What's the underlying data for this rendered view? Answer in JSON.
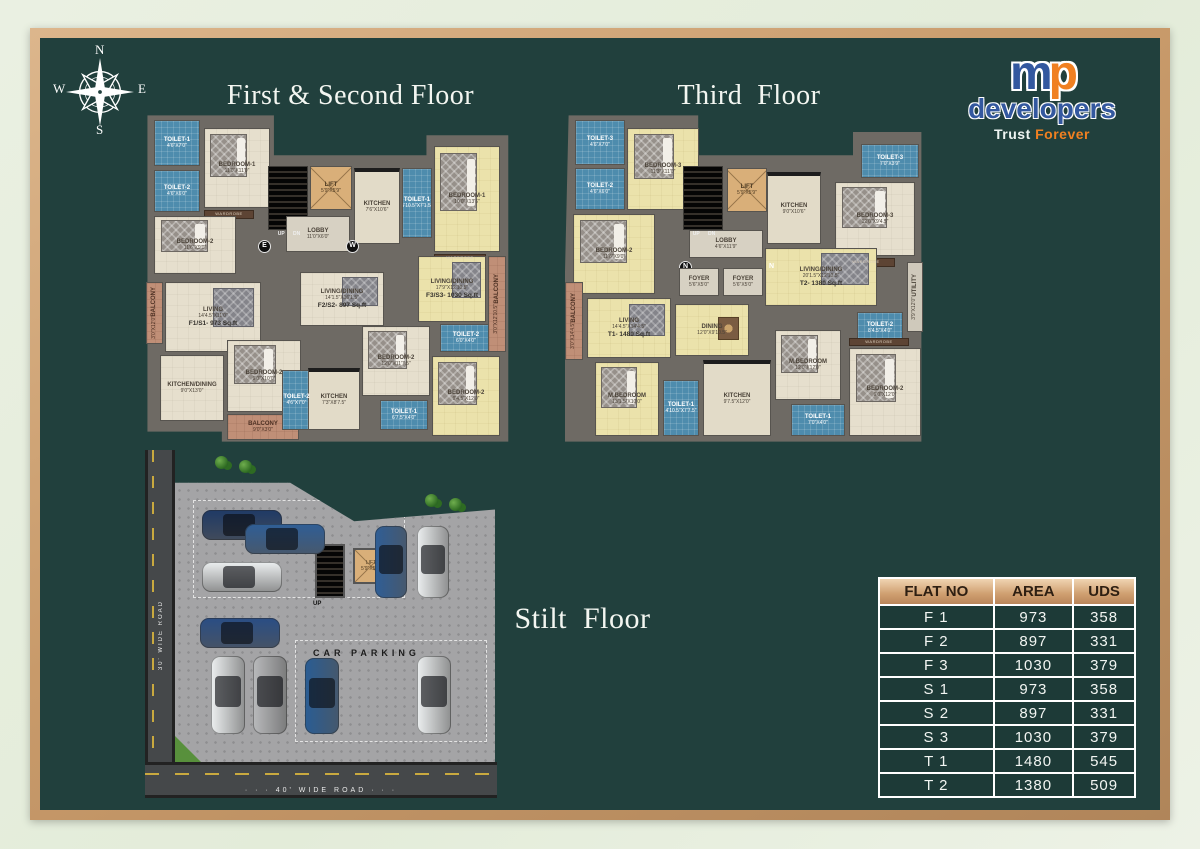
{
  "titles": {
    "first_second": "First & Second Floor",
    "third": "Third  Floor",
    "stilt": "Stilt  Floor"
  },
  "compass": {
    "n": "N",
    "e": "E",
    "s": "S",
    "w": "W"
  },
  "logo": {
    "m": "m",
    "p": "p",
    "name": "developers",
    "tagline_1": "Trust",
    "tagline_2": "Forever",
    "blue": "#33589f",
    "orange": "#f08021"
  },
  "colors": {
    "panel": "#21403d",
    "frame": "#c89a6a",
    "table_header": "#cf9f70",
    "toilet_blue": "#4e8cad",
    "flat_yellow": "#ebe2ab",
    "room_cream": "#e6dfcd"
  },
  "plans": {
    "first_second": {
      "rooms": [
        {
          "t": "toilet",
          "n": "TOILET-1",
          "d": "4'6\"X7'0\"",
          "x": 14,
          "y": 8,
          "w": 46,
          "h": 46
        },
        {
          "t": "toilet",
          "n": "TOILET-2",
          "d": "4'6\"X6'0\"",
          "x": 14,
          "y": 58,
          "w": 46,
          "h": 42
        },
        {
          "t": "room",
          "n": "BEDROOM-1",
          "d": "11'0\"X11'0\"",
          "x": 64,
          "y": 16,
          "w": 66,
          "h": 80,
          "deco": "bed"
        },
        {
          "t": "wb",
          "n": "WARDROBE",
          "x": 64,
          "y": 98,
          "w": 50,
          "h": 9
        },
        {
          "t": "room",
          "n": "BEDROOM-2",
          "d": "11'6\"X9'0\"",
          "x": 14,
          "y": 104,
          "w": 82,
          "h": 58,
          "deco": "bed"
        },
        {
          "t": "stairs",
          "x": 128,
          "y": 54,
          "w": 40,
          "h": 64
        },
        {
          "t": "txt",
          "n": "UP      DN",
          "x": 126,
          "y": 119,
          "w": 46,
          "h": 8
        },
        {
          "t": "lift",
          "n": "LIFT",
          "d": "5'9\"X5'9\"",
          "x": 170,
          "y": 54,
          "w": 42,
          "h": 44
        },
        {
          "t": "lobby",
          "n": "LOBBY",
          "d": "11'0\"X6'0\"",
          "x": 146,
          "y": 104,
          "w": 64,
          "h": 36
        },
        {
          "t": "kitchen",
          "n": "KITCHEN",
          "d": "7'6\"X10'6\"",
          "x": 214,
          "y": 56,
          "w": 46,
          "h": 76
        },
        {
          "t": "toilet",
          "n": "TOILET-1",
          "d": "5'10.5\"X7'1.5\"",
          "x": 262,
          "y": 56,
          "w": 30,
          "h": 70
        },
        {
          "t": "yroom",
          "n": "BEDROOM-1",
          "d": "10'0\"X13'6\"",
          "x": 294,
          "y": 34,
          "w": 66,
          "h": 106,
          "deco": "bed"
        },
        {
          "t": "wb",
          "n": "WARDROBE",
          "x": 294,
          "y": 142,
          "w": 52,
          "h": 9
        },
        {
          "t": "dir",
          "n": "E",
          "x": 118,
          "y": 128
        },
        {
          "t": "dir",
          "n": "W",
          "x": 206,
          "y": 128
        },
        {
          "t": "balc",
          "n": "BALCONY",
          "d": "3'0\"X12'0\"",
          "x": 6,
          "y": 170,
          "w": 17,
          "h": 62,
          "v": 1
        },
        {
          "t": "room",
          "n": "LIVING",
          "d": "14'4.5\"X11'0\"",
          "a": "F1/S1- 973 Sq.ft",
          "x": 25,
          "y": 170,
          "w": 96,
          "h": 70,
          "deco": "rug"
        },
        {
          "t": "room",
          "n": "KITCHEN/DINING",
          "d": "9'0\"X13'0\"",
          "x": 20,
          "y": 243,
          "w": 64,
          "h": 66
        },
        {
          "t": "room",
          "n": "BEDROOM-2",
          "d": "9'0\"X10'0\"",
          "x": 87,
          "y": 228,
          "w": 74,
          "h": 72,
          "deco": "bed"
        },
        {
          "t": "balc",
          "n": "BALCONY",
          "d": "9'0\"X3'0\"",
          "x": 87,
          "y": 302,
          "w": 72,
          "h": 26
        },
        {
          "t": "toilet",
          "n": "TOILET-2",
          "d": "4'6\"X7'0\"",
          "x": 142,
          "y": 258,
          "w": 29,
          "h": 60
        },
        {
          "t": "room",
          "n": "LIVING/DINING",
          "d": "14'1.5\"X16'1.5\"",
          "a": "F2/S2- 897 Sq.ft",
          "x": 160,
          "y": 160,
          "w": 84,
          "h": 54,
          "deco": "rug"
        },
        {
          "t": "kitchen",
          "n": "KITCHEN",
          "d": "7'3\"X8'7.5\"",
          "x": 168,
          "y": 256,
          "w": 52,
          "h": 62
        },
        {
          "t": "room",
          "n": "BEDROOM-2",
          "d": "12'0\"X11'7.5\"",
          "x": 222,
          "y": 214,
          "w": 68,
          "h": 70,
          "deco": "bed"
        },
        {
          "t": "toilet",
          "n": "TOILET-1",
          "d": "6'7.5\"X4'0\"",
          "x": 240,
          "y": 288,
          "w": 48,
          "h": 30
        },
        {
          "t": "yroom",
          "n": "LIVING/DINING",
          "d": "17'9\"X12'10.5\"",
          "a": "F3/S3- 1030 Sq.ft",
          "x": 278,
          "y": 144,
          "w": 68,
          "h": 66,
          "deco": "rug"
        },
        {
          "t": "toilet",
          "n": "TOILET-2",
          "d": "6'0\"X4'0\"",
          "x": 300,
          "y": 212,
          "w": 52,
          "h": 28
        },
        {
          "t": "yroom",
          "n": "BEDROOM-2",
          "d": "9'4.5\"X12'0\"",
          "x": 292,
          "y": 244,
          "w": 68,
          "h": 80,
          "deco": "bed"
        },
        {
          "t": "balc",
          "n": "BALCONY",
          "d": "3'0\"X12'10.5\"",
          "x": 348,
          "y": 144,
          "w": 18,
          "h": 96,
          "v": 1
        }
      ]
    },
    "third": {
      "rooms": [
        {
          "t": "toilet",
          "n": "TOILET-3",
          "d": "4'6\"X7'0\"",
          "x": 10,
          "y": 8,
          "w": 50,
          "h": 45
        },
        {
          "t": "toilet",
          "n": "TOILET-2",
          "d": "4'6\"X6'0\"",
          "x": 10,
          "y": 56,
          "w": 50,
          "h": 42
        },
        {
          "t": "yroom",
          "n": "BEDROOM-3",
          "d": "11'3\"X11'0\"",
          "x": 62,
          "y": 16,
          "w": 72,
          "h": 82,
          "deco": "bed"
        },
        {
          "t": "yroom",
          "n": "BEDROOM-2",
          "d": "11'6\"X9'0\"",
          "x": 8,
          "y": 102,
          "w": 82,
          "h": 80,
          "deco": "bed"
        },
        {
          "t": "stairs",
          "x": 118,
          "y": 54,
          "w": 40,
          "h": 64
        },
        {
          "t": "txt",
          "n": "UP      DN",
          "x": 116,
          "y": 119,
          "w": 46,
          "h": 8
        },
        {
          "t": "lift",
          "n": "LIFT",
          "d": "5'9\"X5'9\"",
          "x": 162,
          "y": 56,
          "w": 40,
          "h": 44
        },
        {
          "t": "lobby",
          "n": "LOBBY",
          "d": "4'6\"X11'9\"",
          "x": 124,
          "y": 118,
          "w": 74,
          "h": 28
        },
        {
          "t": "dir",
          "n": "N",
          "x": 114,
          "y": 149
        },
        {
          "t": "dir",
          "n": "N",
          "x": 200,
          "y": 149
        },
        {
          "t": "foyer",
          "n": "FOYER",
          "d": "5'6\"X5'0\"",
          "x": 114,
          "y": 156,
          "w": 40,
          "h": 28
        },
        {
          "t": "foyer",
          "n": "FOYER",
          "d": "5'6\"X5'0\"",
          "x": 158,
          "y": 156,
          "w": 40,
          "h": 28
        },
        {
          "t": "kitchen",
          "n": "KITCHEN",
          "d": "9'0\"X10'6\"",
          "x": 202,
          "y": 60,
          "w": 54,
          "h": 72
        },
        {
          "t": "toilet",
          "n": "TOILET-3",
          "d": "7'0\"X3'9\"",
          "x": 296,
          "y": 32,
          "w": 58,
          "h": 34
        },
        {
          "t": "room",
          "n": "BEDROOM-3",
          "d": "12'0\"X9'4.5\"",
          "x": 270,
          "y": 70,
          "w": 80,
          "h": 74,
          "deco": "bed"
        },
        {
          "t": "wb",
          "n": "WARDROBE",
          "x": 272,
          "y": 146,
          "w": 58,
          "h": 9
        },
        {
          "t": "yroom",
          "n": "LIVING/DINING",
          "d": "20'1.5\"X12'10.5\"",
          "a": "T2- 1380 Sq.ft",
          "x": 200,
          "y": 136,
          "w": 112,
          "h": 58,
          "deco": "rug"
        },
        {
          "t": "util",
          "n": "UTILITY",
          "d": "3'9\"X12'0\"",
          "x": 342,
          "y": 150,
          "w": 16,
          "h": 70,
          "v": 1
        },
        {
          "t": "balc",
          "n": "BALCONY",
          "d": "3'0\"X14'4.5\"",
          "x": 0,
          "y": 170,
          "w": 18,
          "h": 78,
          "v": 1
        },
        {
          "t": "yroom",
          "n": "LIVING",
          "d": "14'4.5\"X14'4.5\"",
          "a": "T1- 1480 Sq.ft",
          "x": 22,
          "y": 186,
          "w": 84,
          "h": 60,
          "deco": "rug"
        },
        {
          "t": "yroom",
          "n": "DINING",
          "d": "12'0\"X9'10.5\"",
          "x": 110,
          "y": 192,
          "w": 74,
          "h": 52,
          "deco": "table"
        },
        {
          "t": "yroom",
          "n": "M.BEDROOM",
          "d": "13'1.5\"X10'0\"",
          "x": 30,
          "y": 250,
          "w": 64,
          "h": 74,
          "deco": "bed"
        },
        {
          "t": "toilet",
          "n": "TOILET-1",
          "d": "4'10.5\"X7'7.5\"",
          "x": 98,
          "y": 268,
          "w": 36,
          "h": 56
        },
        {
          "t": "kitchen",
          "n": "KITCHEN",
          "d": "9'7.5\"X12'0\"",
          "x": 138,
          "y": 248,
          "w": 68,
          "h": 76
        },
        {
          "t": "room",
          "n": "M.BEDROOM",
          "d": "12'0\"X12'0\"",
          "x": 210,
          "y": 218,
          "w": 66,
          "h": 70,
          "deco": "bed"
        },
        {
          "t": "toilet",
          "n": "TOILET-1",
          "d": "7'0\"X4'0\"",
          "x": 226,
          "y": 292,
          "w": 54,
          "h": 32
        },
        {
          "t": "toilet",
          "n": "TOILET-2",
          "d": "8'4.5\"X4'0\"",
          "x": 292,
          "y": 200,
          "w": 46,
          "h": 32
        },
        {
          "t": "wb",
          "n": "WARDROBE",
          "x": 284,
          "y": 226,
          "w": 60,
          "h": 8
        },
        {
          "t": "room",
          "n": "BEDROOM-2",
          "d": "9'0\"X12'0\"",
          "x": 284,
          "y": 236,
          "w": 72,
          "h": 88,
          "deco": "bed"
        }
      ]
    }
  },
  "stilt": {
    "car_parking_label": "CAR PARKING",
    "lift_name": "LIFT",
    "lift_dims": "5'9\"X5'9\"",
    "up_label": "UP",
    "road_left": "30' WIDE ROAD",
    "road_bottom": "· · ·  40' WIDE ROAD  · · ·",
    "cars": [
      {
        "x": 57,
        "y": 60,
        "w": 80,
        "h": 30,
        "c": "#1f3a66",
        "o": "h"
      },
      {
        "x": 100,
        "y": 74,
        "w": 80,
        "h": 30,
        "c": "#2f5e96",
        "o": "h"
      },
      {
        "x": 57,
        "y": 112,
        "w": 80,
        "h": 30,
        "c": "#eceff0",
        "o": "h"
      },
      {
        "x": 55,
        "y": 168,
        "w": 80,
        "h": 30,
        "c": "#2a4e85",
        "o": "h"
      },
      {
        "x": 230,
        "y": 76,
        "w": 32,
        "h": 72,
        "c": "#2f5e96",
        "o": "v"
      },
      {
        "x": 272,
        "y": 76,
        "w": 32,
        "h": 72,
        "c": "#eceff0",
        "o": "v"
      },
      {
        "x": 66,
        "y": 206,
        "w": 34,
        "h": 78,
        "c": "#eceff0",
        "o": "v"
      },
      {
        "x": 108,
        "y": 206,
        "w": 34,
        "h": 78,
        "c": "#b9babc",
        "o": "v"
      },
      {
        "x": 160,
        "y": 208,
        "w": 34,
        "h": 76,
        "c": "#2a5d94",
        "o": "v"
      },
      {
        "x": 272,
        "y": 206,
        "w": 34,
        "h": 78,
        "c": "#eceff0",
        "o": "v"
      }
    ],
    "trees": [
      {
        "x": 70,
        "y": 6
      },
      {
        "x": 94,
        "y": 10
      },
      {
        "x": 280,
        "y": 44
      },
      {
        "x": 304,
        "y": 48
      }
    ]
  },
  "table": {
    "headers": [
      "FLAT NO",
      "AREA",
      "UDS"
    ],
    "rows": [
      [
        "F 1",
        "973",
        "358"
      ],
      [
        "F 2",
        "897",
        "331"
      ],
      [
        "F 3",
        "1030",
        "379"
      ],
      [
        "S 1",
        "973",
        "358"
      ],
      [
        "S 2",
        "897",
        "331"
      ],
      [
        "S 3",
        "1030",
        "379"
      ],
      [
        "T 1",
        "1480",
        "545"
      ],
      [
        "T 2",
        "1380",
        "509"
      ]
    ]
  }
}
